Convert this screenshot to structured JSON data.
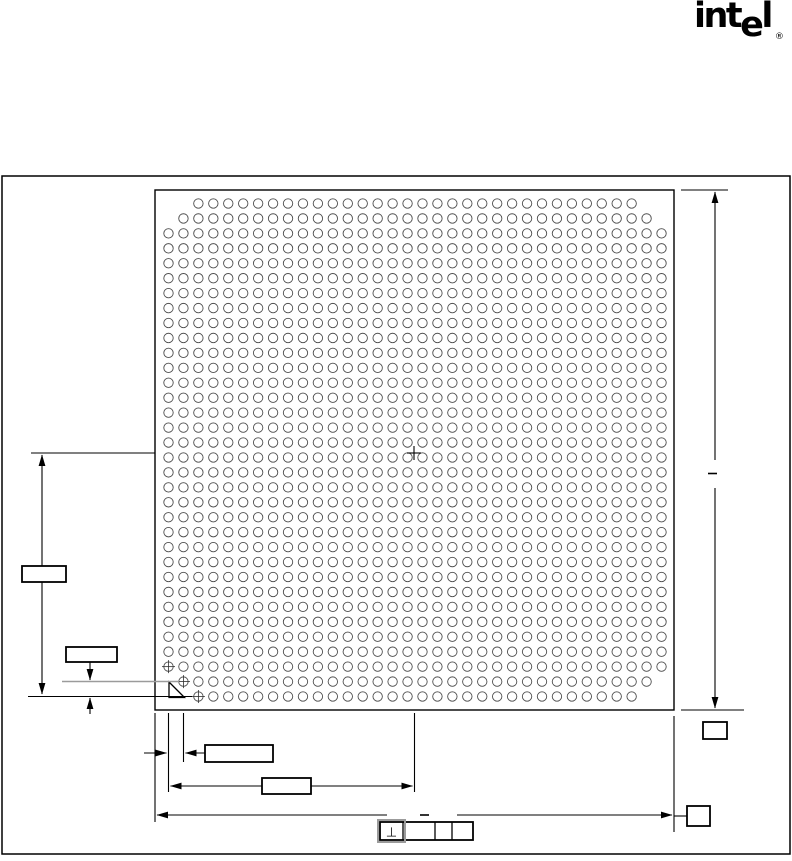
{
  "logo": {
    "part1": "int",
    "part2": "e",
    "part3": "l",
    "registered_mark": "®"
  },
  "drawing_meta": {
    "kind": "BGA package bottom view mechanical drawing",
    "line_color": "#000000",
    "gray_accent_color": "#9b9b9b",
    "background": "#ffffff"
  },
  "package_outline": {
    "x": 155,
    "y": 190,
    "width": 519,
    "height": 520
  },
  "ball_grid": {
    "rows": 34,
    "cols": 34,
    "pitch": 14.94,
    "first_col_x": 168.5,
    "first_row_y": 203.5,
    "ball_radius": 4.7,
    "corner_cutouts": [
      {
        "row": 1,
        "cols": [
          1,
          2,
          33,
          34
        ]
      },
      {
        "row": 2,
        "cols": [
          1,
          34
        ]
      },
      {
        "row": 33,
        "cols": [
          1,
          34
        ]
      },
      {
        "row": 34,
        "cols": [
          1,
          2,
          33,
          34
        ]
      }
    ],
    "target_balls": [
      {
        "row": 32,
        "col": 1
      },
      {
        "row": 33,
        "col": 2
      },
      {
        "row": 34,
        "col": 3
      }
    ]
  },
  "center_mark": {
    "x": 414,
    "y": 453
  },
  "dimensions": {
    "package_height_right": {
      "value_shown": "-",
      "box_label": ""
    },
    "center_to_row_left": {
      "box_label": ""
    },
    "ball_pitch_vertical": {
      "box_label": ""
    },
    "ball_pitch_horizontal": {
      "box_label": ""
    },
    "edge_to_center_bottom": {
      "box_label": ""
    },
    "package_width_bottom": {
      "value_shown": "-",
      "box_label": ""
    }
  },
  "gdt_frame": {
    "cells": [
      {
        "glyph": "⊥",
        "name": "perpendicularity"
      },
      {
        "glyph": "",
        "name": "tolerance"
      },
      {
        "glyph": "",
        "name": "datum-1"
      },
      {
        "glyph": "",
        "name": "datum-2"
      }
    ]
  }
}
